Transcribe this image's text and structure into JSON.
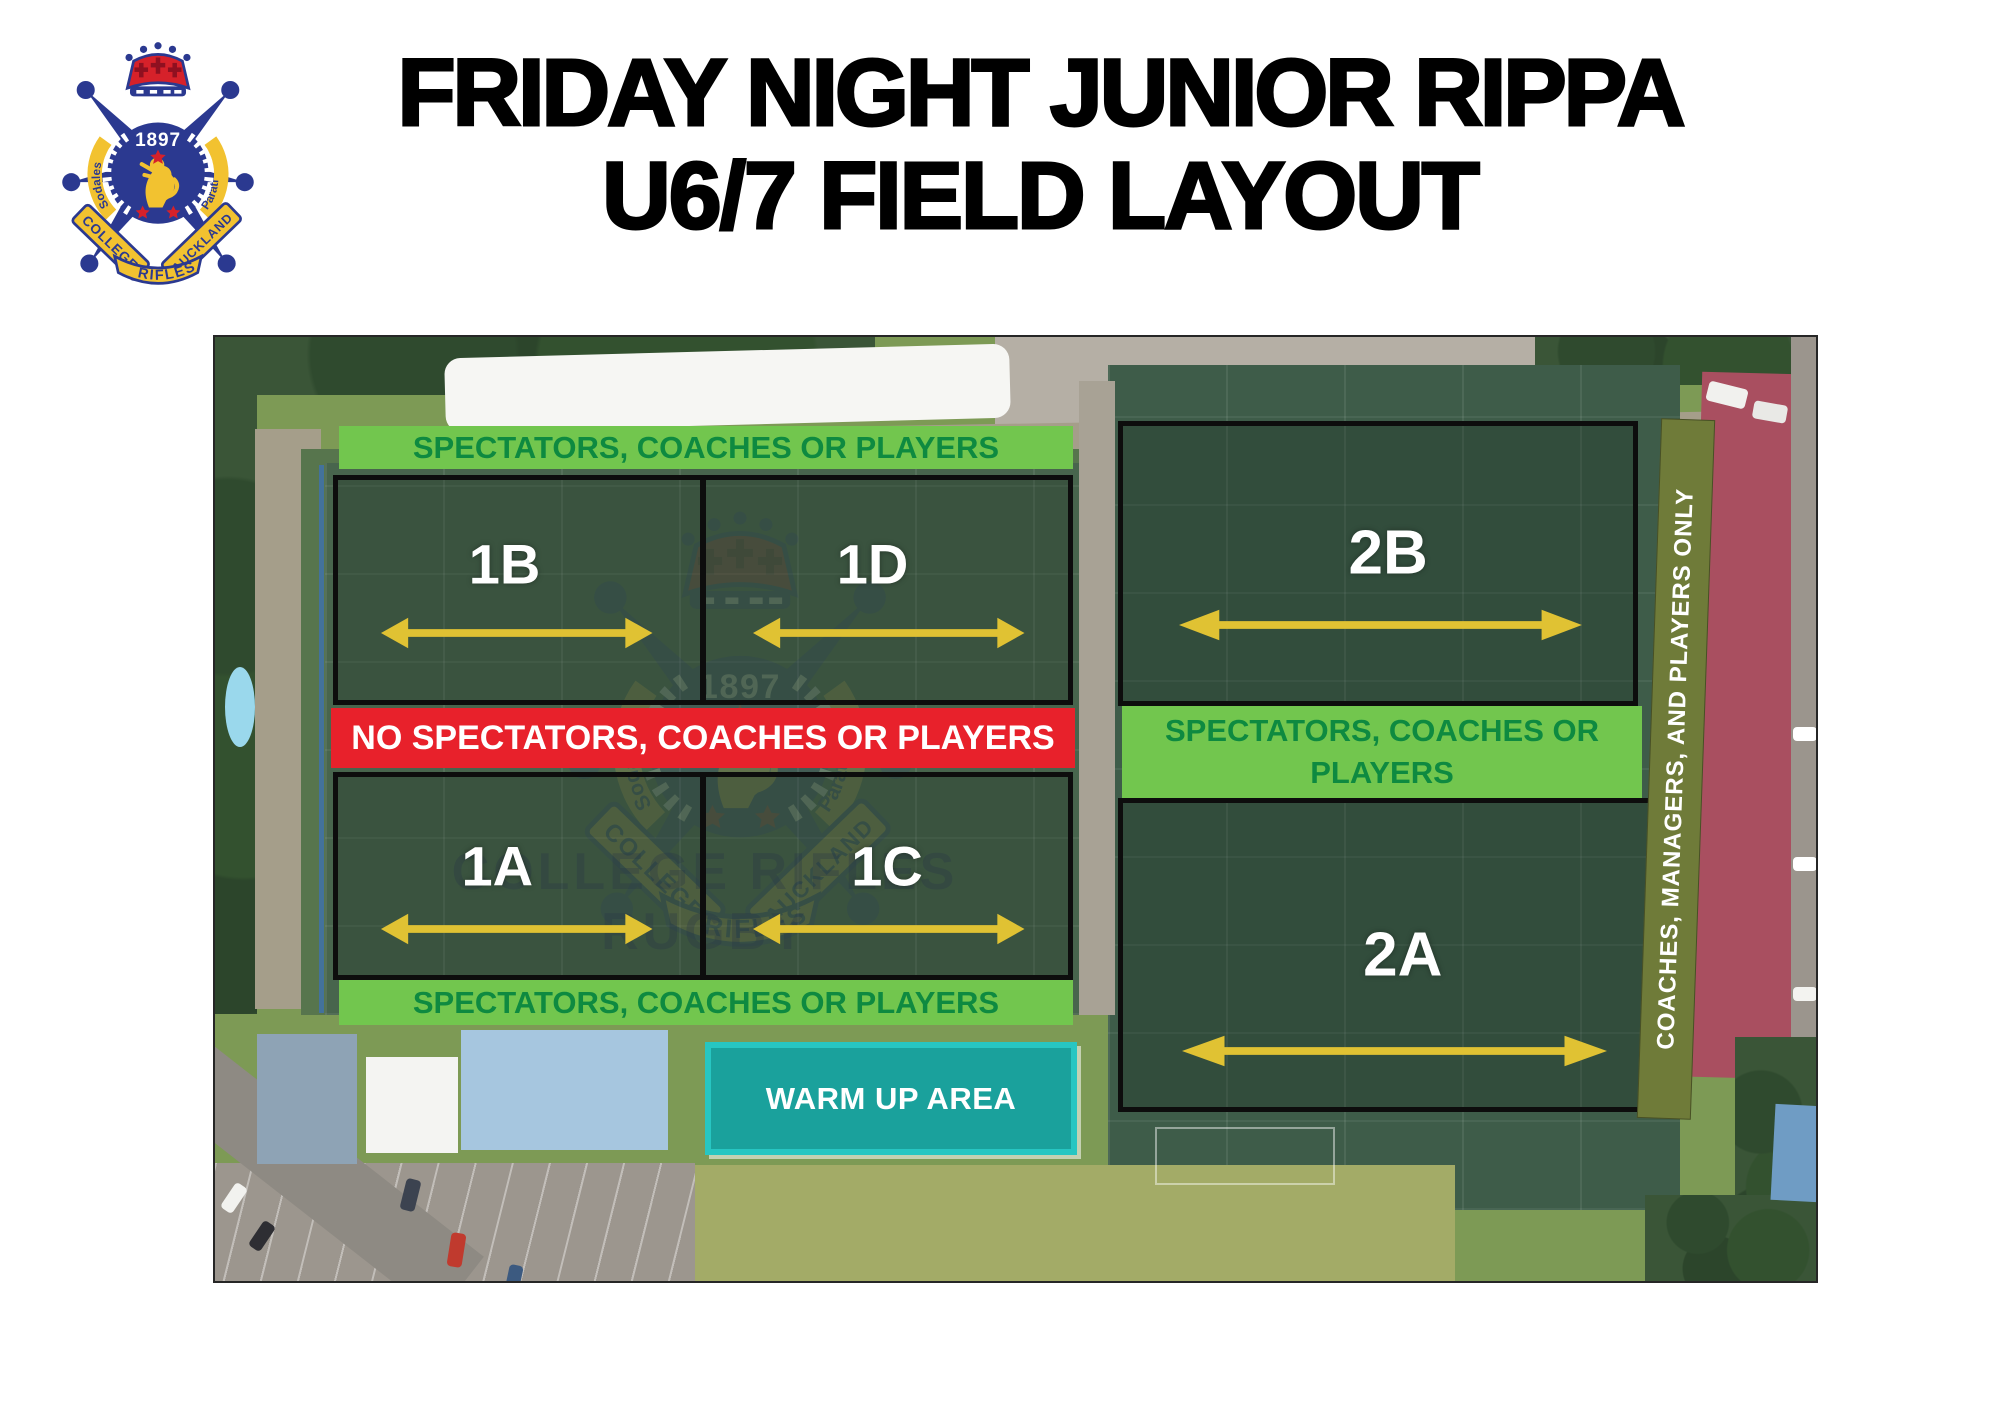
{
  "header": {
    "title_line1": "FRIDAY NIGHT JUNIOR RIPPA",
    "title_line2": "U6/7 FIELD LAYOUT"
  },
  "crest": {
    "year": "1897",
    "ribbon_left": "COLLEGE",
    "ribbon_right": "AUCKLAND",
    "ribbon_bottom": "RIFLES",
    "motto_left": "Sodales",
    "motto_right": "Parati"
  },
  "zones": {
    "top_left_banner": "SPECTATORS, COACHES OR PLAYERS",
    "no_go_banner": "NO SPECTATORS, COACHES OR PLAYERS",
    "bottom_left_banner": "SPECTATORS, COACHES OR PLAYERS",
    "right_banner": "SPECTATORS, COACHES OR PLAYERS",
    "vertical_banner": "COACHES, MANAGERS, AND PLAYERS ONLY",
    "warm_up": "WARM UP AREA"
  },
  "fields": {
    "f1b": "1B",
    "f1d": "1D",
    "f1a": "1A",
    "f1c": "1C",
    "f2b": "2B",
    "f2a": "2A"
  },
  "watermark": {
    "line1": "COLLEGE RIFLES",
    "line2": "RUGBY"
  },
  "colors": {
    "banner-green": "#72c64e",
    "banner-green-text": "#0e8a40",
    "banner-red": "#e8212b",
    "warmup-teal": "#1aa19c",
    "warmup-border": "#27c6c2",
    "vertical-olive": "#6f7b39",
    "arrow-yellow": "#e0c233",
    "field-border": "#0d0d0d",
    "label-white": "#ffffff"
  }
}
